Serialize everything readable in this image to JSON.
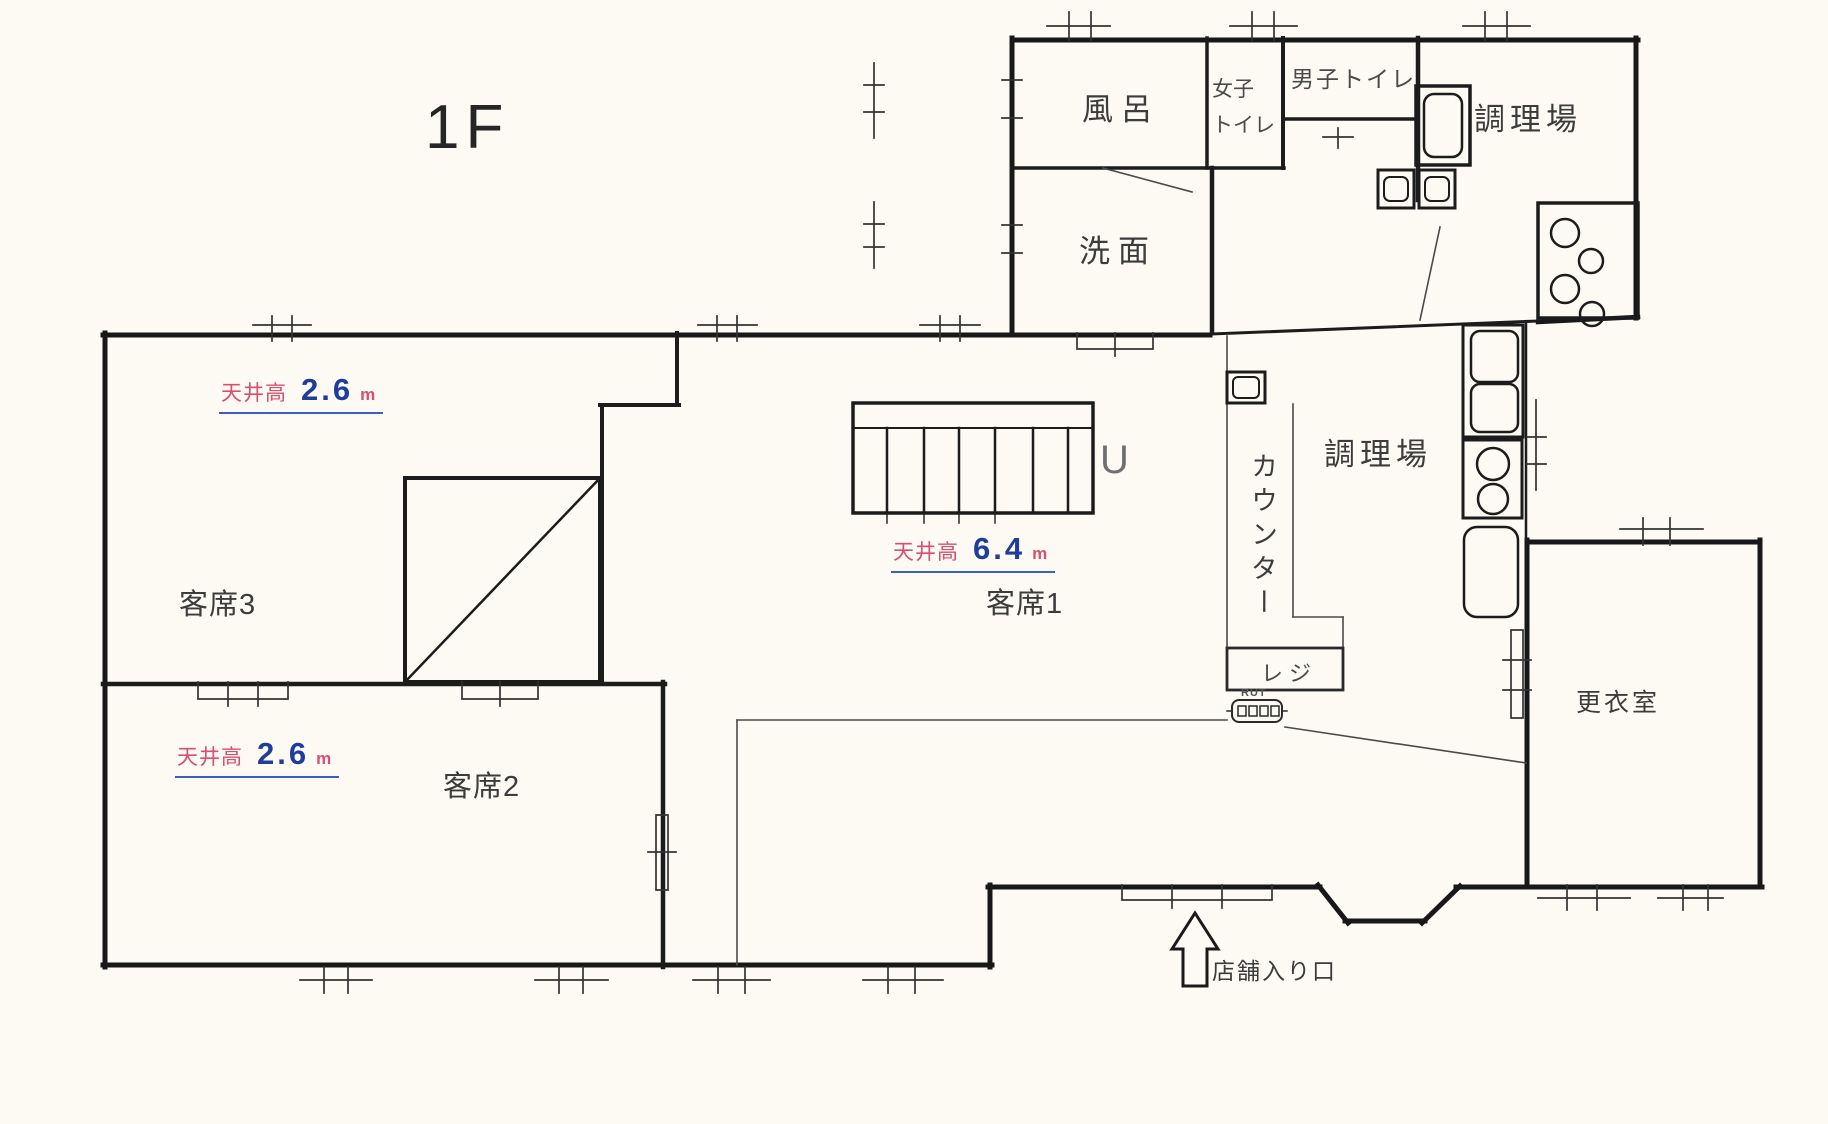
{
  "title": "1F",
  "labels": {
    "bath": "風呂",
    "womens_toilet_l1": "女子",
    "womens_toilet_l2": "トイレ",
    "mens_toilet": "男子トイレ",
    "kitchen_upper": "調理場",
    "washroom": "洗面",
    "kitchen_main": "調理場",
    "counter": "カウンター",
    "register": "レジ",
    "pos_unit": "RUT",
    "stairs_up_mark": "U",
    "seating_1": "客席1",
    "seating_2": "客席2",
    "seating_3": "客席3",
    "changing_room": "更衣室",
    "entrance": "店舗入り口"
  },
  "ceiling_heights": {
    "seating_3": {
      "label": "天井高",
      "value": "2.6",
      "unit": "m"
    },
    "seating_1": {
      "label": "天井高",
      "value": "6.4",
      "unit": "m"
    },
    "seating_2": {
      "label": "天井高",
      "value": "2.6",
      "unit": "m"
    }
  },
  "colors": {
    "wall": "#181818",
    "thin_line": "#4a4a4a",
    "tick": "#333333",
    "label_text": "#3f3f3f",
    "ceiling_label_red": "#d8506e",
    "ceiling_value_blue": "#1f3d9c",
    "underline_blue": "#3d5fc0",
    "background": "#fcfaf3"
  }
}
